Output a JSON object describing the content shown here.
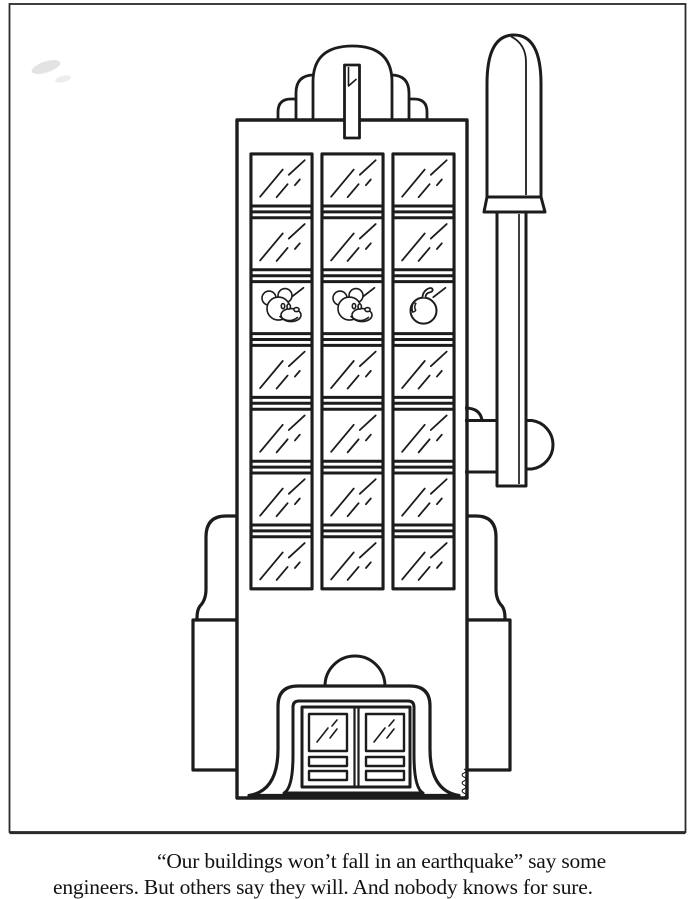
{
  "page": {
    "kind": "scanned cartoon / coloring-book page",
    "paper_color": "#ffffff",
    "ink_color": "#1c1c1c"
  },
  "caption": {
    "line1": "“Our buildings won’t fall in an earthquake” say some",
    "line2": "engineers. But others say they will. And nobody knows for sure."
  },
  "illustration": {
    "subject": "office tower drawn as a slot machine with coin slot, pull lever and reel symbols in the windows",
    "window_grid": {
      "columns": 3,
      "rows": 7,
      "symbol_row_index": 2,
      "symbols": [
        "mickey-mouse",
        "mickey-mouse",
        "apple"
      ]
    },
    "entrance": {
      "doors": 2
    }
  }
}
